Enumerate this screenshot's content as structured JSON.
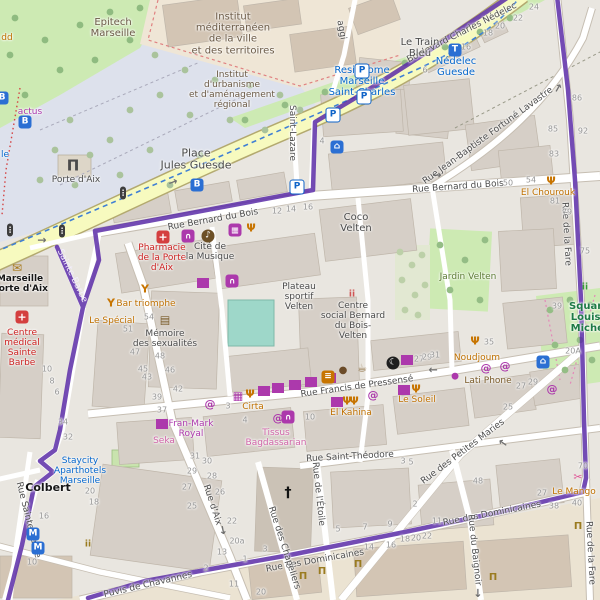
{
  "map": {
    "route": {
      "color": "#5b2ca8"
    },
    "street_labels": [
      {
        "t": "Boulevard Charles Nédelec",
        "x": 462,
        "y": 33,
        "r": -27
      },
      {
        "t": "Rue Bernard du Bois",
        "x": 213,
        "y": 220,
        "r": -10
      },
      {
        "t": "Rue Bernard du Bois",
        "x": 458,
        "y": 187,
        "r": -4
      },
      {
        "t": "Rue Jean-Baptiste Fortuné Lavastre",
        "x": 488,
        "y": 136,
        "r": -36
      },
      {
        "t": "Saint-Lazare",
        "x": 292,
        "y": 133,
        "r": 90
      },
      {
        "t": "aggi",
        "x": 341,
        "y": 30,
        "r": 80
      },
      {
        "t": "Sainte-Barbe",
        "x": 72,
        "y": 276,
        "r": 64,
        "c": "stw"
      },
      {
        "t": "Rue Francis de Pressensé",
        "x": 357,
        "y": 387,
        "r": -8
      },
      {
        "t": "Rue Saint-Théodore",
        "x": 350,
        "y": 457,
        "r": -3
      },
      {
        "t": "Rue de l'Étoile",
        "x": 318,
        "y": 494,
        "r": 84
      },
      {
        "t": "Rue d'Aix",
        "x": 212,
        "y": 505,
        "r": 72
      },
      {
        "t": "Rue des Petites Maries",
        "x": 463,
        "y": 452,
        "r": -37
      },
      {
        "t": "Rue des Dominicaines",
        "x": 315,
        "y": 561,
        "r": -10
      },
      {
        "t": "Rue des Dominicaines",
        "x": 492,
        "y": 514,
        "r": -11
      },
      {
        "t": "Puvis de Chavannes",
        "x": 148,
        "y": 585,
        "r": -13
      },
      {
        "t": "Rue Sainte-Barbe",
        "x": 28,
        "y": 520,
        "r": 76
      },
      {
        "t": "Rue des Chapeliers",
        "x": 284,
        "y": 548,
        "r": 72
      },
      {
        "t": "Rue du Baignoir",
        "x": 474,
        "y": 550,
        "r": 84
      },
      {
        "t": "Rue de la Fare",
        "x": 566,
        "y": 234,
        "r": 87
      },
      {
        "t": "Rue de la Fare",
        "x": 590,
        "y": 553,
        "r": 87
      }
    ],
    "place_labels": [
      {
        "lines": [
          "Epitech",
          "Marseille"
        ],
        "x": 113,
        "y": 28,
        "c": "inst",
        "s": 10
      },
      {
        "lines": [
          "Institut",
          "méditerranéen",
          "de la ville",
          "et des territoires"
        ],
        "x": 233,
        "y": 34,
        "c": "inst",
        "s": 10
      },
      {
        "lines": [
          "Institut",
          "d'urbanisme",
          "et d'aménagement",
          "régional"
        ],
        "x": 232,
        "y": 90,
        "c": "inst",
        "s": 9
      },
      {
        "lines": [
          "Place",
          "Jules Guesde"
        ],
        "x": 196,
        "y": 160,
        "c": "place",
        "s": 11
      },
      {
        "t": "Porte d'Aix",
        "x": 76,
        "y": 180,
        "c": "place",
        "s": 9
      },
      {
        "lines": [
          "Le Train",
          "Bleu"
        ],
        "x": 420,
        "y": 48,
        "c": "place",
        "s": 10
      },
      {
        "lines": [
          "Nédelec",
          "Guesde"
        ],
        "x": 456,
        "y": 67,
        "c": "blue",
        "s": 10
      },
      {
        "lines": [
          "Residhome",
          "Marseille",
          "Saint-Charles"
        ],
        "x": 362,
        "y": 82,
        "c": "blue",
        "s": 10
      },
      {
        "lines": [
          "Coco",
          "Velten"
        ],
        "x": 356,
        "y": 223,
        "c": "place",
        "s": 10
      },
      {
        "lines": [
          "Pharmacie",
          "de la Porte",
          "d'Aix"
        ],
        "x": 162,
        "y": 258,
        "c": "red",
        "s": 9
      },
      {
        "lines": [
          "Cité de",
          "la Musique"
        ],
        "x": 210,
        "y": 252,
        "c": "place",
        "s": 9
      },
      {
        "lines": [
          "Plateau",
          "sportif",
          "Velten"
        ],
        "x": 299,
        "y": 297,
        "c": "place",
        "s": 9
      },
      {
        "lines": [
          "Centre",
          "social Bernard",
          "du Bois-",
          "Velten"
        ],
        "x": 353,
        "y": 321,
        "c": "place",
        "s": 9
      },
      {
        "t": "Jardin Velten",
        "x": 468,
        "y": 277,
        "c": "green",
        "s": 9
      },
      {
        "t": "El Chourouk",
        "x": 548,
        "y": 193,
        "c": "orange",
        "s": 9
      },
      {
        "lines": [
          "Mémoire",
          "des sexualités"
        ],
        "x": 165,
        "y": 339,
        "c": "place",
        "s": 9
      },
      {
        "t": "Bar triomphe",
        "x": 146,
        "y": 304,
        "c": "orange",
        "s": 9
      },
      {
        "t": "Le Spécial",
        "x": 112,
        "y": 321,
        "c": "orange",
        "s": 9
      },
      {
        "lines": [
          "Centre",
          "médical",
          "Sainte",
          "Barbe"
        ],
        "x": 22,
        "y": 348,
        "c": "red",
        "s": 9
      },
      {
        "lines": [
          "Marseille",
          "Porte d'Aix"
        ],
        "x": 20,
        "y": 284,
        "c": "dark",
        "s": 9
      },
      {
        "lines": [
          "Fran-Mark",
          "Royal"
        ],
        "x": 191,
        "y": 429,
        "c": "purple",
        "s": 9
      },
      {
        "t": "Seka",
        "x": 164,
        "y": 441,
        "c": "pink",
        "s": 9
      },
      {
        "lines": [
          "Tissus",
          "Bagdassarian"
        ],
        "x": 276,
        "y": 438,
        "c": "pink",
        "s": 9
      },
      {
        "t": "Cirta",
        "x": 253,
        "y": 407,
        "c": "orange",
        "s": 9
      },
      {
        "t": "El Kahina",
        "x": 351,
        "y": 413,
        "c": "orange",
        "s": 9
      },
      {
        "t": "Le Soleil",
        "x": 417,
        "y": 400,
        "c": "orange",
        "s": 9
      },
      {
        "t": "Noudjoum",
        "x": 477,
        "y": 358,
        "c": "orange",
        "s": 9
      },
      {
        "t": "Lati Phone",
        "x": 488,
        "y": 381,
        "c": "brown",
        "s": 9
      },
      {
        "lines": [
          "Staycity",
          "Aparthotels",
          "Marseille"
        ],
        "x": 80,
        "y": 471,
        "c": "blue",
        "s": 9
      },
      {
        "lines": [
          "Square",
          "Louise",
          "Michel"
        ],
        "x": 589,
        "y": 318,
        "c": "parkbold",
        "s": 10
      },
      {
        "t": "Le Mango",
        "x": 574,
        "y": 492,
        "c": "orange",
        "s": 9
      },
      {
        "t": "Colbert",
        "x": 48,
        "y": 488,
        "c": "dark",
        "s": 11
      },
      {
        "t": "actus",
        "x": 30,
        "y": 112,
        "c": "purple",
        "s": 9
      },
      {
        "t": "dd",
        "x": 7,
        "y": 38,
        "c": "orange",
        "s": 9
      },
      {
        "t": "le",
        "x": 5,
        "y": 155,
        "c": "blue",
        "s": 9
      },
      {
        "t": "20A",
        "x": 573,
        "y": 352,
        "c": "num",
        "s": 8
      }
    ],
    "house_numbers": [
      [
        "24",
        534,
        8
      ],
      [
        "22",
        518,
        19
      ],
      [
        "20",
        500,
        27
      ],
      [
        "18",
        488,
        34
      ],
      [
        "16",
        466,
        48
      ],
      [
        "6",
        425,
        71
      ],
      [
        "86",
        577,
        99
      ],
      [
        "85",
        553,
        130
      ],
      [
        "92",
        583,
        132
      ],
      [
        "83",
        554,
        155
      ],
      [
        "50",
        508,
        184
      ],
      [
        "54",
        531,
        181
      ],
      [
        "81",
        555,
        202
      ],
      [
        "79",
        567,
        213
      ],
      [
        "75",
        585,
        252
      ],
      [
        "12",
        277,
        212
      ],
      [
        "14",
        291,
        210
      ],
      [
        "16",
        308,
        208
      ],
      [
        "4",
        322,
        142
      ],
      [
        "54",
        149,
        318
      ],
      [
        "51",
        128,
        330
      ],
      [
        "47",
        135,
        353
      ],
      [
        "48",
        160,
        357
      ],
      [
        "45",
        143,
        370
      ],
      [
        "46",
        170,
        371
      ],
      [
        "43",
        147,
        378
      ],
      [
        "42",
        178,
        390
      ],
      [
        "39",
        157,
        398
      ],
      [
        "37",
        162,
        411
      ],
      [
        "34",
        63,
        423
      ],
      [
        "32",
        68,
        438
      ],
      [
        "10",
        47,
        370
      ],
      [
        "8",
        52,
        382
      ],
      [
        "6",
        57,
        393
      ],
      [
        "3",
        228,
        407
      ],
      [
        "4",
        245,
        421
      ],
      [
        "10",
        310,
        418
      ],
      [
        "27",
        419,
        360
      ],
      [
        "29",
        427,
        358
      ],
      [
        "31",
        435,
        356
      ],
      [
        "35",
        489,
        343
      ],
      [
        "39",
        557,
        307
      ],
      [
        "25",
        508,
        408
      ],
      [
        "27",
        521,
        387
      ],
      [
        "29",
        533,
        383
      ],
      [
        "31",
        195,
        457
      ],
      [
        "29",
        192,
        472
      ],
      [
        "27",
        187,
        488
      ],
      [
        "25",
        192,
        507
      ],
      [
        "16",
        44,
        517
      ],
      [
        "10",
        32,
        563
      ],
      [
        "20",
        90,
        492
      ],
      [
        "18",
        94,
        503
      ],
      [
        "30",
        207,
        462
      ],
      [
        "28",
        212,
        477
      ],
      [
        "26",
        220,
        493
      ],
      [
        "22",
        232,
        522
      ],
      [
        "20a",
        237,
        542
      ],
      [
        "13",
        222,
        553
      ],
      [
        "2",
        206,
        569
      ],
      [
        "1",
        245,
        560
      ],
      [
        "3",
        265,
        550
      ],
      [
        "11",
        234,
        585
      ],
      [
        "20",
        261,
        593
      ],
      [
        "5",
        338,
        530
      ],
      [
        "7",
        365,
        528
      ],
      [
        "9",
        390,
        525
      ],
      [
        "3",
        403,
        462
      ],
      [
        "5",
        411,
        463
      ],
      [
        "2",
        415,
        505
      ],
      [
        "11",
        437,
        522
      ],
      [
        "48",
        478,
        482
      ],
      [
        "27",
        542,
        494
      ],
      [
        "38",
        554,
        507
      ],
      [
        "40",
        577,
        504
      ],
      [
        "70",
        583,
        467
      ],
      [
        "18",
        405,
        540
      ],
      [
        "20",
        416,
        539
      ],
      [
        "22",
        427,
        537
      ],
      [
        "14",
        369,
        548
      ],
      [
        "16",
        391,
        546
      ]
    ],
    "icons": [
      {
        "k": "parking",
        "x": 362,
        "y": 71
      },
      {
        "k": "parking",
        "x": 364,
        "y": 97
      },
      {
        "k": "parking",
        "x": 333,
        "y": 115
      },
      {
        "k": "parking",
        "x": 297,
        "y": 187
      },
      {
        "k": "bus",
        "x": 25,
        "y": 122
      },
      {
        "k": "bus",
        "x": 2,
        "y": 98
      },
      {
        "k": "bus",
        "x": 197,
        "y": 185
      },
      {
        "k": "tram",
        "x": 455,
        "y": 50
      },
      {
        "k": "metro",
        "x": 33,
        "y": 534
      },
      {
        "k": "metro",
        "x": 38,
        "y": 548
      },
      {
        "k": "bed",
        "x": 337,
        "y": 147
      },
      {
        "k": "bed",
        "x": 543,
        "y": 362
      },
      {
        "k": "traffic",
        "x": 10,
        "y": 230
      },
      {
        "k": "traffic",
        "x": 62,
        "y": 231
      },
      {
        "k": "traffic",
        "x": 123,
        "y": 193
      },
      {
        "k": "arrow",
        "x": 42,
        "y": 240,
        "r": 0
      },
      {
        "k": "arrow",
        "x": 173,
        "y": 182,
        "r": -20
      },
      {
        "k": "arrow",
        "x": 433,
        "y": 370,
        "r": 180
      },
      {
        "k": "arrow",
        "x": 503,
        "y": 443,
        "r": 215
      },
      {
        "k": "arrow",
        "x": 558,
        "y": 88,
        "r": -60
      },
      {
        "k": "arrow",
        "x": 437,
        "y": 175,
        "r": 0
      },
      {
        "k": "arrow",
        "x": 223,
        "y": 530,
        "r": 80
      },
      {
        "k": "arrow",
        "x": 478,
        "y": 593,
        "r": 90
      },
      {
        "k": "shirt",
        "x": 264,
        "y": 391
      },
      {
        "k": "shirt",
        "x": 278,
        "y": 388
      },
      {
        "k": "shirt",
        "x": 295,
        "y": 385
      },
      {
        "k": "shirt",
        "x": 311,
        "y": 382
      },
      {
        "k": "shirt",
        "x": 330,
        "y": 378
      },
      {
        "k": "shirt",
        "x": 203,
        "y": 283
      },
      {
        "k": "shirt",
        "x": 407,
        "y": 360
      },
      {
        "k": "shirt",
        "x": 337,
        "y": 402
      },
      {
        "k": "shirt",
        "x": 404,
        "y": 390
      },
      {
        "k": "shirt",
        "x": 162,
        "y": 424
      },
      {
        "k": "bag",
        "x": 188,
        "y": 236
      },
      {
        "k": "bag",
        "x": 232,
        "y": 281
      },
      {
        "k": "bag",
        "x": 288,
        "y": 417
      },
      {
        "k": "basket",
        "x": 235,
        "y": 230
      },
      {
        "k": "at",
        "x": 210,
        "y": 404
      },
      {
        "k": "at",
        "x": 278,
        "y": 418
      },
      {
        "k": "at",
        "x": 373,
        "y": 395
      },
      {
        "k": "at",
        "x": 486,
        "y": 368
      },
      {
        "k": "at",
        "x": 505,
        "y": 366
      },
      {
        "k": "at",
        "x": 552,
        "y": 389
      },
      {
        "k": "grid",
        "x": 238,
        "y": 396
      },
      {
        "k": "apple",
        "x": 455,
        "y": 377
      },
      {
        "k": "mosque",
        "x": 393,
        "y": 363
      },
      {
        "k": "fork",
        "x": 250,
        "y": 394
      },
      {
        "k": "fork",
        "x": 347,
        "y": 401
      },
      {
        "k": "fork",
        "x": 354,
        "y": 401
      },
      {
        "k": "fork",
        "x": 416,
        "y": 389
      },
      {
        "k": "fork",
        "x": 251,
        "y": 228
      },
      {
        "k": "fork",
        "x": 551,
        "y": 181
      },
      {
        "k": "fork",
        "x": 475,
        "y": 341
      },
      {
        "k": "cup",
        "x": 362,
        "y": 368
      },
      {
        "k": "cookie",
        "x": 343,
        "y": 371
      },
      {
        "k": "burger",
        "x": 328,
        "y": 377
      },
      {
        "k": "cocktail",
        "x": 145,
        "y": 289
      },
      {
        "k": "cocktail",
        "x": 111,
        "y": 303
      },
      {
        "k": "book",
        "x": 165,
        "y": 320
      },
      {
        "k": "music",
        "x": 208,
        "y": 236
      },
      {
        "k": "mail",
        "x": 17,
        "y": 268
      },
      {
        "k": "health",
        "x": 22,
        "y": 317
      },
      {
        "k": "pharmacy",
        "x": 163,
        "y": 237
      },
      {
        "k": "bank",
        "x": 303,
        "y": 577
      },
      {
        "k": "bank",
        "x": 322,
        "y": 572
      },
      {
        "k": "bank",
        "x": 358,
        "y": 565
      },
      {
        "k": "bank",
        "x": 578,
        "y": 527
      },
      {
        "k": "bank",
        "x": 493,
        "y": 578
      },
      {
        "k": "people",
        "x": 88,
        "y": 545
      },
      {
        "k": "peoplered",
        "x": 352,
        "y": 295
      },
      {
        "k": "playground",
        "x": 585,
        "y": 288
      },
      {
        "k": "scissors",
        "x": 578,
        "y": 477
      },
      {
        "k": "monument",
        "x": 73,
        "y": 166
      },
      {
        "k": "church",
        "x": 288,
        "y": 493
      }
    ]
  }
}
